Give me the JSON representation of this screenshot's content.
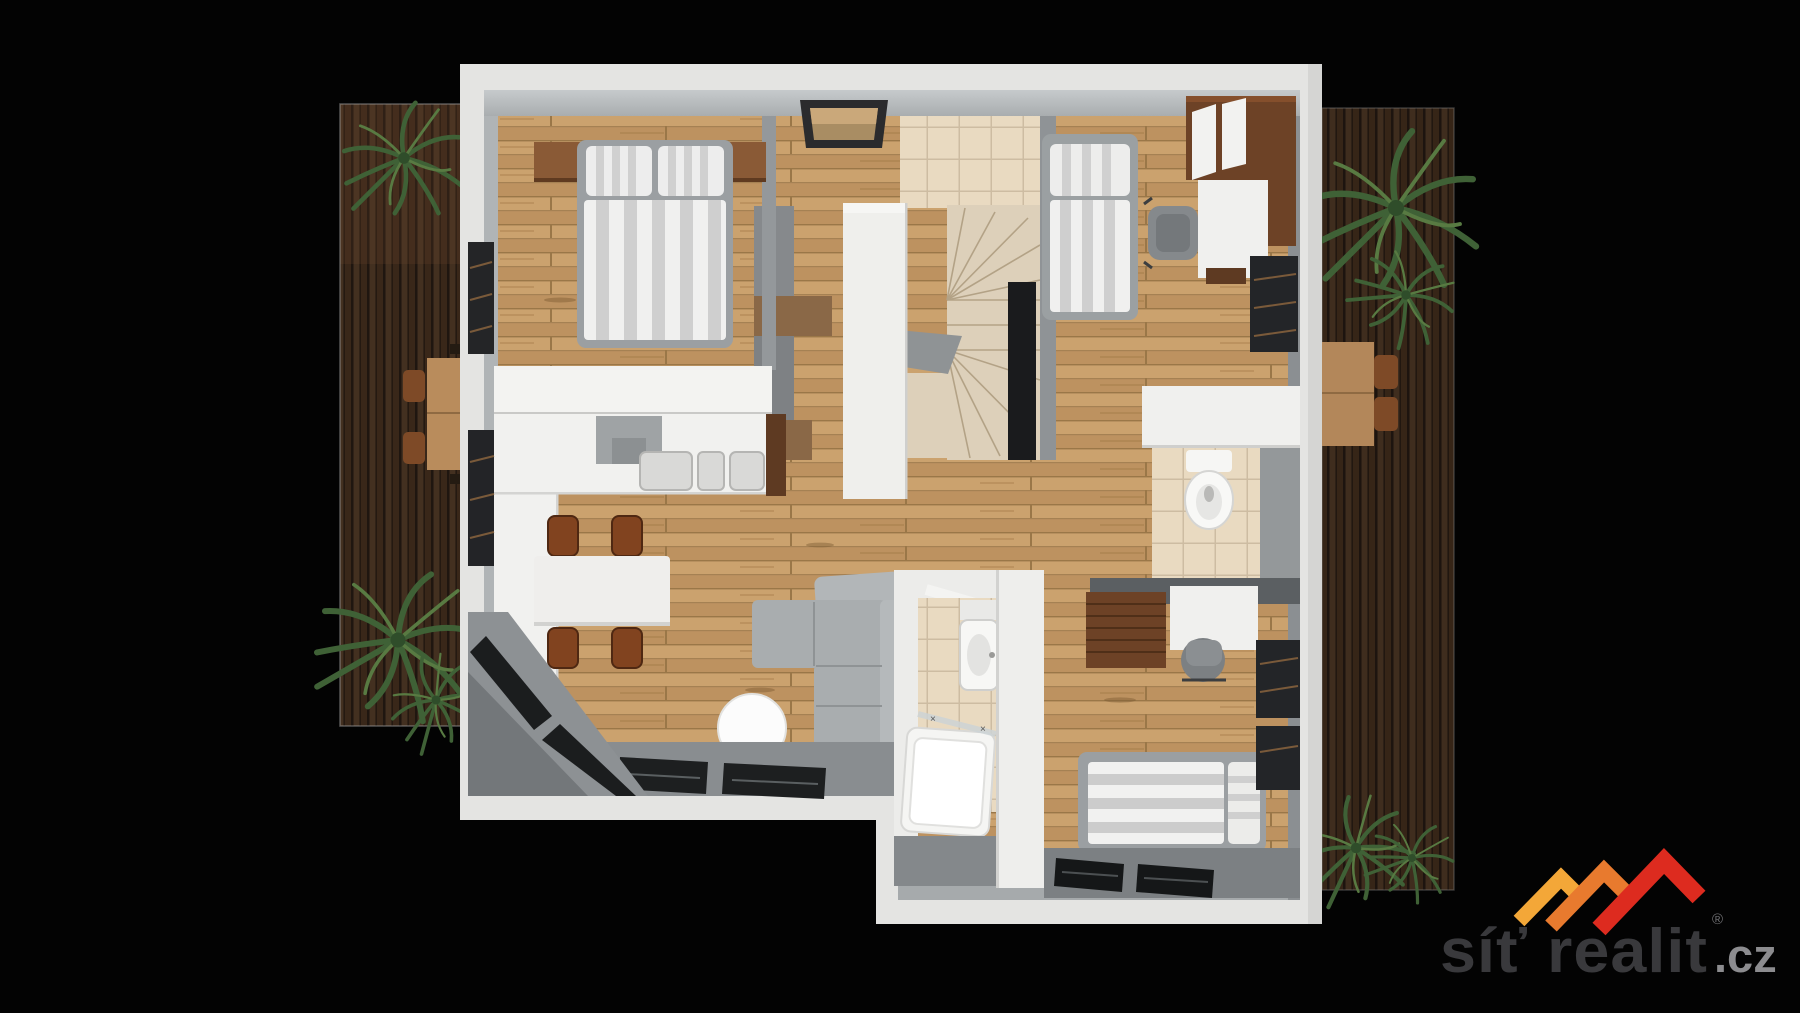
{
  "scene": {
    "type": "3d-floor-plan-top-view-render",
    "background_color": "#000000",
    "floor_color": "#c49a66",
    "wall_outer_color": "#e4e4e2",
    "wall_inner_color": "#a6aaac",
    "tile_color": "#e9dac1",
    "deck_color": "#66482f"
  },
  "branding": {
    "logo_text": "síť realit",
    "registered_mark": "®",
    "tld": ".cz",
    "logo_text_color": "#39393c",
    "tld_color": "#8c8c8f",
    "roof_colors": {
      "left": "#f3a738",
      "middle": "#e87a2e",
      "right": "#dd2b1f"
    }
  },
  "floor_plan": {
    "terraces": [
      {
        "id": "left-terrace",
        "features": [
          "wood-deck",
          "palm-plants",
          "outdoor-table",
          "chairs"
        ]
      },
      {
        "id": "right-terrace",
        "features": [
          "wood-deck",
          "palm-plants",
          "outdoor-table",
          "chairs"
        ]
      }
    ],
    "rooms": [
      {
        "id": "bedroom-top-left",
        "furniture": [
          "double-bed",
          "striped-duvet",
          "two-pillows",
          "headboard-shelf",
          "white-closet",
          "window"
        ]
      },
      {
        "id": "hallway",
        "furniture": [
          "skylight",
          "storage-cabinets",
          "tall-white-closet"
        ]
      },
      {
        "id": "staircase",
        "furniture": [
          "winder-stairs",
          "tiled-landing",
          "stair-void"
        ]
      },
      {
        "id": "bedroom-top-right",
        "furniture": [
          "single-bed",
          "desk",
          "office-chair",
          "walnut-wardrobe",
          "window"
        ]
      },
      {
        "id": "kitchen",
        "furniture": [
          "l-shaped-counter",
          "cooktop",
          "double-sink",
          "dining-table",
          "four-chairs"
        ]
      },
      {
        "id": "living-room",
        "furniture": [
          "l-shaped-sofa",
          "round-table",
          "sliding-glass-doors",
          "corner-windows"
        ]
      },
      {
        "id": "bathroom-center",
        "furniture": [
          "bathtub",
          "glass-screen",
          "washbasin",
          "door"
        ]
      },
      {
        "id": "wc",
        "furniture": [
          "toilet",
          "white-cabinet",
          "tiled-floor"
        ]
      },
      {
        "id": "bedroom-bottom-right",
        "furniture": [
          "double-bed",
          "striped-duvet",
          "walnut-wardrobe",
          "desk",
          "office-chair",
          "windows"
        ]
      }
    ]
  }
}
